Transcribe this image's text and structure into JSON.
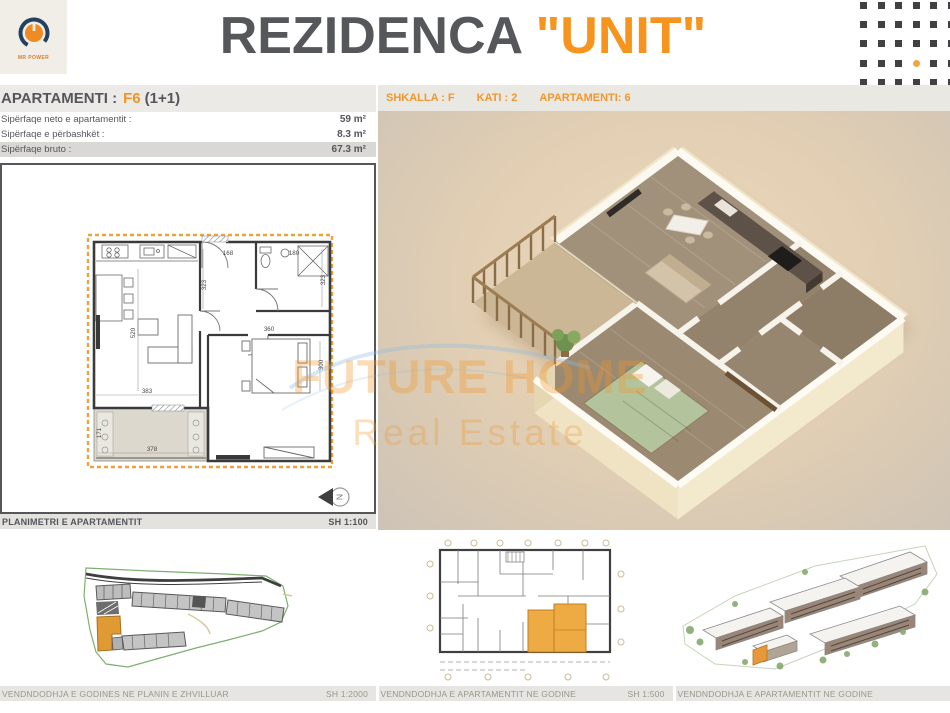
{
  "colors": {
    "accent": "#f7941e",
    "heading": "#56575b"
  },
  "header": {
    "logo_text": "MR POWER",
    "title_main": "REZIDENCA",
    "title_accent": "\"UNIT\"",
    "dots": {
      "rows": 5,
      "cols": 6,
      "accent_row": 3,
      "accent_col": 3
    }
  },
  "apartment_panel": {
    "title_prefix": "APARTAMENTI :",
    "unit_code": "F6",
    "unit_type": "(1+1)",
    "rows": [
      {
        "label": "Sipërfaqe neto e apartamentit :",
        "value": "59 m²"
      },
      {
        "label": "Sipërfaqe e përbashkët :",
        "value": "8.3 m²"
      },
      {
        "label": "Sipërfaqe bruto :",
        "value": "67.3 m²"
      }
    ]
  },
  "floor_bar": {
    "segments": [
      "SHKALLA : F",
      "KATI : 2",
      "APARTAMENTI: 6"
    ]
  },
  "plan": {
    "caption": "PLANIMETRI E APARTAMENTIT",
    "scale": "SH 1:100",
    "north_label": "N",
    "dims": {
      "living_w": "383",
      "living_h": "520",
      "hall_h": "323",
      "entry_w": "168",
      "bath_w": "180",
      "bath_h": "323",
      "bed_w": "360",
      "bed_h": "300",
      "balcony_w": "378",
      "balcony_h": "171"
    }
  },
  "watermark": {
    "line1": "FUTURE HOME",
    "line2": "Real Estate"
  },
  "bottom": {
    "panels": [
      {
        "caption": "VENDNDODHJA E GODINES NE PLANIN E ZHVILLUAR",
        "scale": "SH 1:2000"
      },
      {
        "caption": "VENDNDODHJA E APARTAMENTIT NE GODINE",
        "scale": "SH 1:500"
      },
      {
        "caption": "VENDNDODHJA E APARTAMENTIT NE GODINE",
        "scale": ""
      }
    ]
  }
}
